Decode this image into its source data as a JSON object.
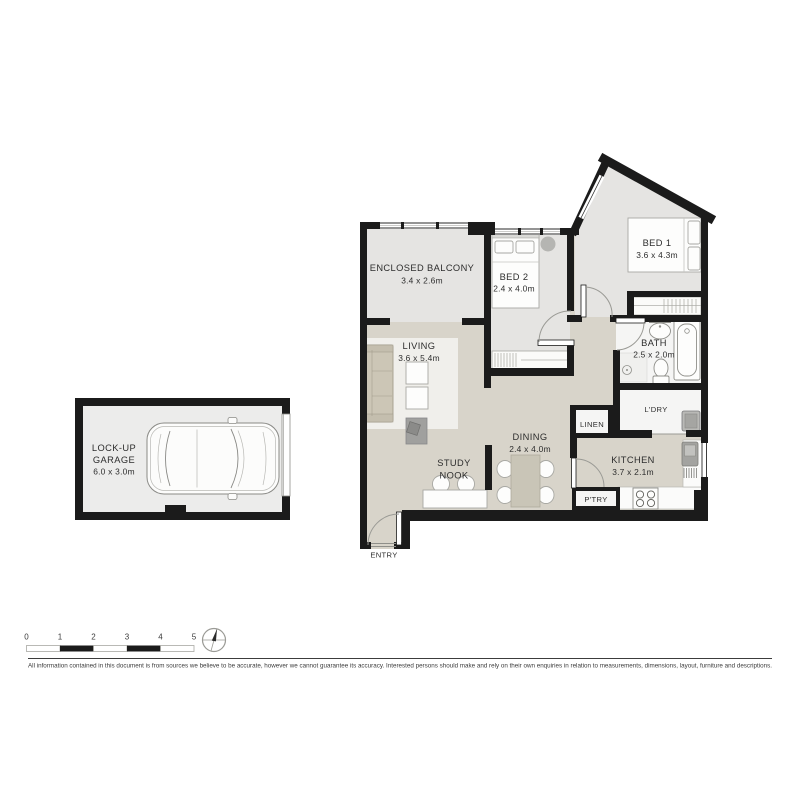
{
  "floorplan": {
    "rooms": {
      "balcony": {
        "name": "ENCLOSED BALCONY",
        "dims": "3.4 x 2.6m"
      },
      "bed2": {
        "name": "BED 2",
        "dims": "2.4 x 4.0m"
      },
      "bed1": {
        "name": "BED 1",
        "dims": "3.6 x 4.3m"
      },
      "living": {
        "name": "LIVING",
        "dims": "3.6 x 5.4m"
      },
      "bath": {
        "name": "BATH",
        "dims": "2.5 x 2.0m"
      },
      "dining": {
        "name": "DINING",
        "dims": "2.4 x 4.0m"
      },
      "study": {
        "line1": "STUDY",
        "line2": "NOOK"
      },
      "kitchen": {
        "name": "KITCHEN",
        "dims": "3.7 x 2.1m"
      },
      "linen": {
        "name": "LINEN"
      },
      "laundry": {
        "name": "L'DRY"
      },
      "pantry": {
        "name": "P'TRY"
      },
      "entry": {
        "name": "ENTRY"
      }
    },
    "garage": {
      "line1": "LOCK-UP",
      "line2": "GARAGE",
      "dims": "6.0 x 3.0m"
    }
  },
  "scale_bar": {
    "labels": [
      "0",
      "1",
      "2",
      "3",
      "4",
      "5"
    ]
  },
  "footer": {
    "disclaimer": "All information contained in this document is from sources we believe to be accurate, however we cannot guarantee its accuracy. Interested persons should make and rely on their own enquiries in relation to measurements, dimensions, layout, furniture and descriptions."
  },
  "colors": {
    "wall": "#1b1b1b",
    "floor_living_areas": "#d8d4ca",
    "floor_bedrooms": "#e5e4e2",
    "floor_wet_areas": "#f5f5f4",
    "floor_garage": "#ececeb",
    "label_text": "#2d2d2d"
  }
}
